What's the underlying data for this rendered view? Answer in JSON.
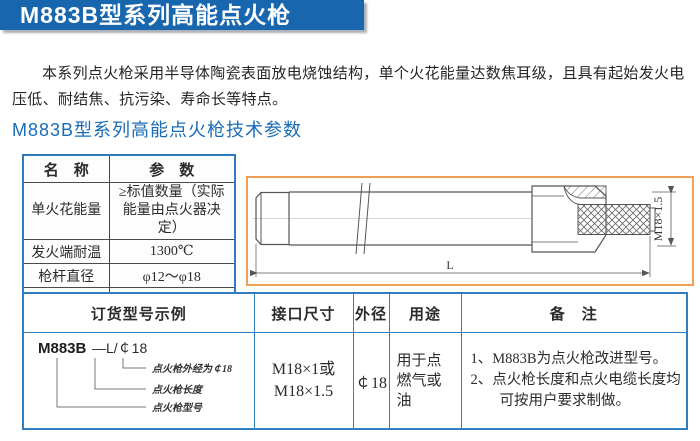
{
  "header": {
    "title": "M883B型系列高能点火枪"
  },
  "intro": {
    "text": "本系列点火枪采用半导体陶瓷表面放电烧蚀结构，单个火花能量达数焦耳级，且具有起始发火电压低、耐结焦、抗污染、寿命长等特点。"
  },
  "section": {
    "heading": "M883B型系列高能点火枪技术参数"
  },
  "spec_table": {
    "col_name": "名　称",
    "col_param": "参　数",
    "rows": [
      {
        "name": "单火花能量",
        "value": "≥标值数量（实际能量由点火器决定）"
      },
      {
        "name": "发火端耐温",
        "value": "1300℃"
      },
      {
        "name": "枪杆直径",
        "value": "φ12～φ18"
      },
      {
        "name": "连接螺纹",
        "value": "M18×1.5"
      }
    ]
  },
  "drawing": {
    "length_label": "L",
    "thread_label": "M18×1.5"
  },
  "order_table": {
    "headers": {
      "model_example": "订货型号示例",
      "interface_size": "接口尺寸",
      "outer_diameter": "外径",
      "usage": "用途",
      "remarks": "备　注"
    },
    "model_example": {
      "model": "M883B",
      "suffix": "—L/￠18",
      "callout_diameter": "点火枪外经为￠18",
      "callout_length": "点火枪长度",
      "callout_model": "点火枪型号"
    },
    "interface_size_line1": "M18×1或",
    "interface_size_line2": "M18×1.5",
    "outer_diameter": "￠18",
    "usage": "用于点燃气或油",
    "remarks": [
      "1、M883B为点火枪改进型号。",
      "2、点火枪长度和点火电缆长度均可按用户要求制做。"
    ]
  },
  "colors": {
    "title_bar": "#1866ae",
    "heading": "#1a6cb8",
    "table_border_blue": "#2f7ec2",
    "spec_inner_border": "#4a4a4a",
    "drawing_border_orange": "#f0a055"
  }
}
